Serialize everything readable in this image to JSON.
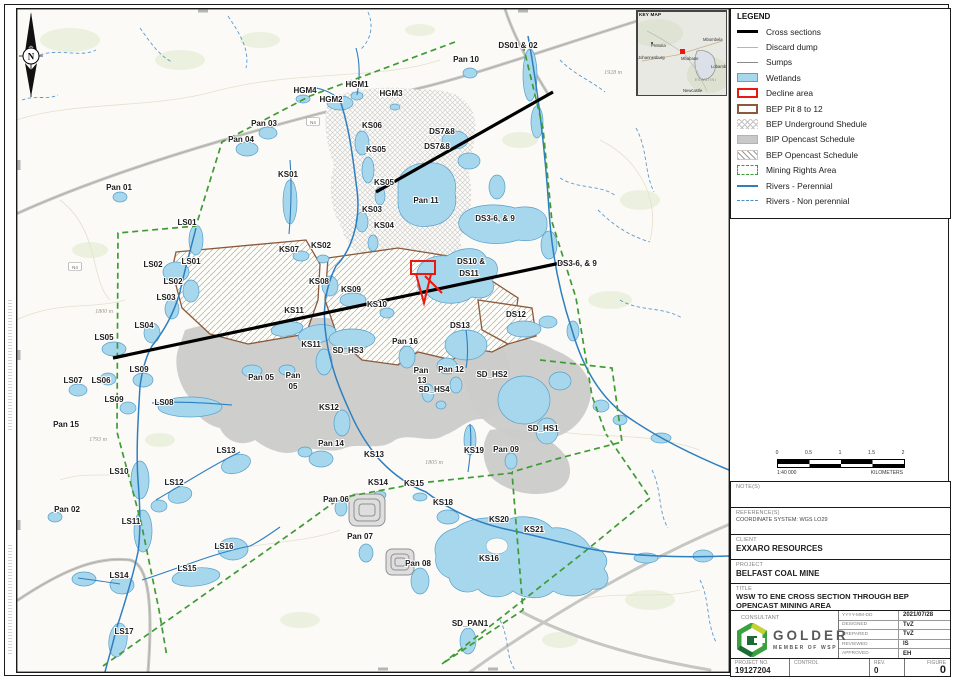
{
  "legend": {
    "title": "LEGEND",
    "items": [
      {
        "label": "Cross sections",
        "swatch": "line-black-thick",
        "icon": "cross-section-line-icon"
      },
      {
        "label": "Discard dump",
        "swatch": "line-gray-thin",
        "icon": "discard-dump-line-icon"
      },
      {
        "label": "Sumps",
        "swatch": "line-gray",
        "icon": "sumps-line-icon"
      },
      {
        "label": "Wetlands",
        "swatch": "fill-lightblue",
        "icon": "wetlands-swatch-icon"
      },
      {
        "label": "Decline area",
        "swatch": "outline-red",
        "icon": "decline-area-swatch-icon"
      },
      {
        "label": "BEP Pit 8 to 12",
        "swatch": "outline-brown",
        "icon": "bep-pit-swatch-icon"
      },
      {
        "label": "BEP Underground Shedule",
        "swatch": "hatch-diamond",
        "icon": "bep-underground-hatch-icon"
      },
      {
        "label": "BIP Opencast Schedule",
        "swatch": "fill-gray",
        "icon": "bip-opencast-swatch-icon"
      },
      {
        "label": "BEP Opencast Schedule",
        "swatch": "hatch-diagonal",
        "icon": "bep-opencast-hatch-icon"
      },
      {
        "label": "Mining Rights Area",
        "swatch": "dash-green",
        "icon": "mining-rights-dash-icon"
      },
      {
        "label": "Rivers - Perennial",
        "swatch": "line-blue",
        "icon": "river-perennial-line-icon"
      },
      {
        "label": "Rivers - Non perennial",
        "swatch": "dash-blue",
        "icon": "river-nonperennial-dash-icon"
      }
    ]
  },
  "key_map": {
    "title": "KEY MAP",
    "marker_color": "#e8190f",
    "cities": [
      {
        "t": "Pretoria",
        "x": 14,
        "y": 36,
        "cls": "kcity"
      },
      {
        "t": "Johannesburg",
        "x": 1,
        "y": 48,
        "cls": "kcity"
      },
      {
        "t": "Mbombela",
        "x": 66,
        "y": 30,
        "cls": "kcity"
      },
      {
        "t": "Mbabane",
        "x": 44,
        "y": 49,
        "cls": "kcity"
      },
      {
        "t": "Lobamba",
        "x": 74,
        "y": 57,
        "cls": "kcity"
      },
      {
        "t": "ESWATINI",
        "x": 58,
        "y": 70,
        "cls": "kregion"
      },
      {
        "t": "Newcastle",
        "x": 46,
        "y": 81,
        "cls": "kcity"
      }
    ]
  },
  "north_arrow": {
    "letter": "N"
  },
  "scale_bar": {
    "ticks": [
      "0",
      "0.5",
      "1",
      "1.5",
      "2"
    ],
    "ratio": "1:40 000",
    "units": "KILOMETERS"
  },
  "title_block": {
    "note_label": "NOTE(S)",
    "reference_label": "REFERENCE(S)",
    "reference_value": "COORDINATE SYSTEM: WGS LO29",
    "client_label": "CLIENT",
    "client_value": "EXXARO RESOURCES",
    "project_label": "PROJECT",
    "project_value": "BELFAST COAL MINE",
    "title_label": "TITLE",
    "title_value": "WSW TO ENE CROSS SECTION THROUGH BEP OPENCAST MINING AREA",
    "consultant_label": "CONSULTANT",
    "logo_name": "GOLDER",
    "logo_tagline": "MEMBER OF WSP",
    "fields": [
      {
        "label": "YYYY-MM-DD",
        "value": "2021/07/28"
      },
      {
        "label": "DESIGNED",
        "value": "TvZ"
      },
      {
        "label": "PREPARED",
        "value": "TvZ"
      },
      {
        "label": "REVIEWED",
        "value": "IS"
      },
      {
        "label": "APPROVED",
        "value": "EH"
      }
    ],
    "project_no_label": "PROJECT NO.",
    "project_no_value": "19127204",
    "control_label": "CONTROL",
    "control_value": "",
    "rev_label": "REV.",
    "rev_value": "0",
    "figure_label": "FIGURE",
    "figure_value": "0"
  },
  "map": {
    "colors": {
      "wetland": "#a7d7ec",
      "wetland_edge": "#5ba3cc",
      "river_perennial": "#2e7fc0",
      "river_non_perennial": "#5b9ad0",
      "mining_rights": "#3f9b35",
      "bep_pit_outline": "#8a5a3b",
      "decline_area": "#e8190f",
      "opencast_fill": "#c9c9c9",
      "cross_section": "#000000"
    },
    "labels": [
      {
        "t": "DS01 & 02",
        "x": 518,
        "y": 48
      },
      {
        "t": "Pan 10",
        "x": 466,
        "y": 62
      },
      {
        "t": "HGM1",
        "x": 357,
        "y": 87
      },
      {
        "t": "HGM4",
        "x": 305,
        "y": 93
      },
      {
        "t": "HGM2",
        "x": 331,
        "y": 102
      },
      {
        "t": "HGM3",
        "x": 391,
        "y": 96
      },
      {
        "t": "Pan 03",
        "x": 264,
        "y": 126
      },
      {
        "t": "Pan 04",
        "x": 241,
        "y": 142
      },
      {
        "t": "KS06",
        "x": 372,
        "y": 128
      },
      {
        "t": "DS7&8",
        "x": 442,
        "y": 134
      },
      {
        "t": "KS05",
        "x": 376,
        "y": 152
      },
      {
        "t": "DS7&8",
        "x": 437,
        "y": 149
      },
      {
        "t": "Pan 01",
        "x": 119,
        "y": 190
      },
      {
        "t": "KS01",
        "x": 288,
        "y": 177
      },
      {
        "t": "KS05",
        "x": 384,
        "y": 185
      },
      {
        "t": "Pan 11",
        "x": 426,
        "y": 203
      },
      {
        "t": "KS03",
        "x": 372,
        "y": 212
      },
      {
        "t": "DS3-6, & 9",
        "x": 495,
        "y": 221
      },
      {
        "t": "LS01",
        "x": 187,
        "y": 225
      },
      {
        "t": "KS04",
        "x": 384,
        "y": 228
      },
      {
        "t": "KS02",
        "x": 321,
        "y": 248
      },
      {
        "t": "KS07",
        "x": 289,
        "y": 252
      },
      {
        "t": "DS10 &",
        "x": 471,
        "y": 264
      },
      {
        "t": "DS11",
        "x": 469,
        "y": 276
      },
      {
        "t": "DS3-6, & 9",
        "x": 577,
        "y": 266
      },
      {
        "t": "LS02",
        "x": 153,
        "y": 267
      },
      {
        "t": "LS01",
        "x": 191,
        "y": 264
      },
      {
        "t": "LS02",
        "x": 173,
        "y": 284
      },
      {
        "t": "KS08",
        "x": 319,
        "y": 284
      },
      {
        "t": "LS03",
        "x": 166,
        "y": 300
      },
      {
        "t": "KS09",
        "x": 351,
        "y": 292
      },
      {
        "t": "KS10",
        "x": 377,
        "y": 307
      },
      {
        "t": "KS11",
        "x": 294,
        "y": 313
      },
      {
        "t": "DS12",
        "x": 516,
        "y": 317
      },
      {
        "t": "DS13",
        "x": 460,
        "y": 328
      },
      {
        "t": "LS04",
        "x": 144,
        "y": 328
      },
      {
        "t": "LS05",
        "x": 104,
        "y": 340
      },
      {
        "t": "KS11",
        "x": 311,
        "y": 347
      },
      {
        "t": "SD_HS3",
        "x": 348,
        "y": 353
      },
      {
        "t": "Pan 16",
        "x": 405,
        "y": 344
      },
      {
        "t": "LS09",
        "x": 139,
        "y": 372
      },
      {
        "t": "LS07",
        "x": 73,
        "y": 383
      },
      {
        "t": "LS06",
        "x": 101,
        "y": 383
      },
      {
        "t": "Pan 05",
        "x": 261,
        "y": 380
      },
      {
        "t": "Pan",
        "x": 293,
        "y": 378
      },
      {
        "t": "05",
        "x": 293,
        "y": 389
      },
      {
        "t": "Pan 12",
        "x": 451,
        "y": 372
      },
      {
        "t": "Pan",
        "x": 421,
        "y": 373
      },
      {
        "t": "13",
        "x": 422,
        "y": 383
      },
      {
        "t": "SD_HS2",
        "x": 492,
        "y": 377
      },
      {
        "t": "SD_HS4",
        "x": 434,
        "y": 392
      },
      {
        "t": "LS09",
        "x": 114,
        "y": 402
      },
      {
        "t": "LS08",
        "x": 164,
        "y": 405
      },
      {
        "t": "Pan 15",
        "x": 66,
        "y": 427
      },
      {
        "t": "KS12",
        "x": 329,
        "y": 410
      },
      {
        "t": "SD_HS1",
        "x": 543,
        "y": 431
      },
      {
        "t": "LS13",
        "x": 226,
        "y": 453
      },
      {
        "t": "Pan 14",
        "x": 331,
        "y": 446
      },
      {
        "t": "KS13",
        "x": 374,
        "y": 457
      },
      {
        "t": "KS19",
        "x": 474,
        "y": 453
      },
      {
        "t": "Pan 09",
        "x": 506,
        "y": 452
      },
      {
        "t": "LS10",
        "x": 119,
        "y": 474
      },
      {
        "t": "LS12",
        "x": 174,
        "y": 485
      },
      {
        "t": "KS14",
        "x": 378,
        "y": 485
      },
      {
        "t": "KS15",
        "x": 414,
        "y": 486
      },
      {
        "t": "Pan 06",
        "x": 336,
        "y": 502
      },
      {
        "t": "KS18",
        "x": 443,
        "y": 505
      },
      {
        "t": "Pan 02",
        "x": 67,
        "y": 512
      },
      {
        "t": "KS20",
        "x": 499,
        "y": 522
      },
      {
        "t": "KS21",
        "x": 534,
        "y": 532
      },
      {
        "t": "LS11",
        "x": 131,
        "y": 524
      },
      {
        "t": "Pan 07",
        "x": 360,
        "y": 539
      },
      {
        "t": "LS16",
        "x": 224,
        "y": 549
      },
      {
        "t": "KS16",
        "x": 489,
        "y": 561
      },
      {
        "t": "Pan 08",
        "x": 418,
        "y": 566
      },
      {
        "t": "LS15",
        "x": 187,
        "y": 571
      },
      {
        "t": "LS14",
        "x": 119,
        "y": 578
      },
      {
        "t": "SD_PAN1",
        "x": 470,
        "y": 626
      },
      {
        "t": "LS17",
        "x": 124,
        "y": 634
      }
    ],
    "elevation_labels": [
      {
        "t": "1928 m",
        "x": 613,
        "y": 74
      },
      {
        "t": "1800 m",
        "x": 104,
        "y": 313
      },
      {
        "t": "1793 m",
        "x": 98,
        "y": 441
      },
      {
        "t": "1805 m",
        "x": 434,
        "y": 464
      }
    ],
    "road_shields": [
      {
        "t": "N4",
        "x": 75,
        "y": 267
      },
      {
        "t": "N4",
        "x": 313,
        "y": 122
      }
    ]
  }
}
